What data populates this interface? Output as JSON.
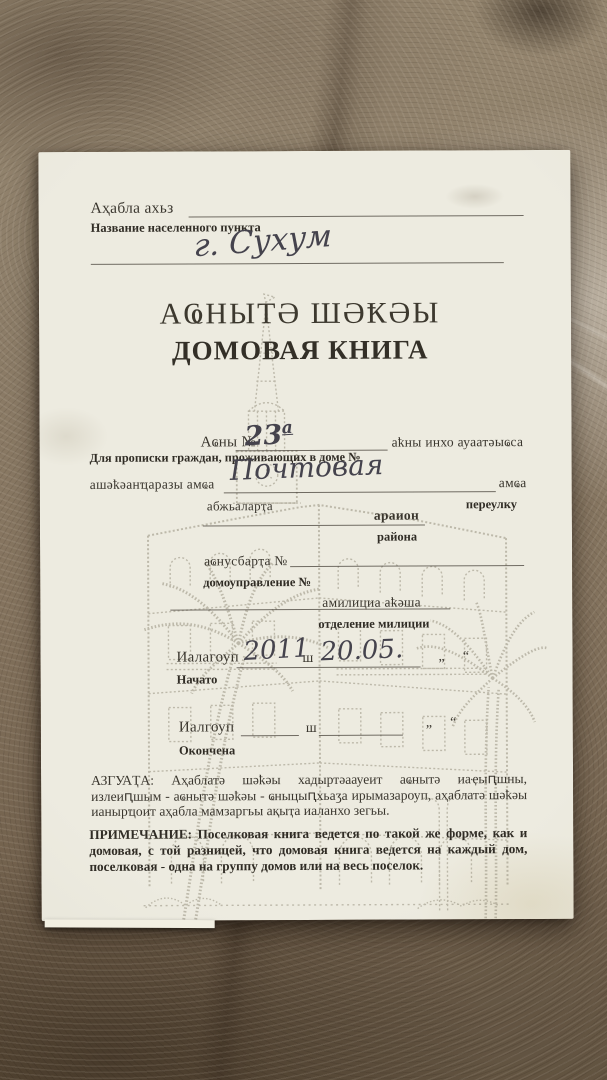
{
  "photo": {
    "surface": "marble countertop",
    "surface_base_color": "#87786a",
    "paper_color": "#eae8db"
  },
  "booklet": {
    "header": {
      "settlement_label_abkhaz": "Аҳабла ахьз",
      "settlement_label_russian": "Название населенного пункта",
      "settlement_value_handwritten": "г. Сухум"
    },
    "title": {
      "abkhaz": "АҨНЫТӘ ШӘҞӘЫ",
      "russian": "ДОМОВАЯ КНИГА"
    },
    "form": {
      "house_number": {
        "label_abkhaz": "Аҩны №",
        "value_handwritten": "23",
        "value_superscript": "а",
        "suffix_abkhaz": "аҟны инхо ауаатәыҩса",
        "label_russian": "Для прописки граждан, проживающих в доме №"
      },
      "street": {
        "label_abkhaz": "ашәҟәанҵаразы амҩа",
        "value_handwritten": "Почтовая",
        "suffix_abkhaz": "амҩа",
        "lane_label_abkhaz": "абжьаларҭа",
        "lane_label_russian": "переулку"
      },
      "district": {
        "label_abkhaz": "араион",
        "label_russian": "района"
      },
      "house_management": {
        "label_abkhaz": "аҩнусбарҭа №",
        "label_russian": "домоуправление №"
      },
      "militia": {
        "label_abkhaz": "амилициа аҟәша",
        "label_russian": "отделение милиции"
      },
      "started": {
        "label_abkhaz": "Иалагоуп",
        "label_russian": "Начато",
        "year_handwritten": "2011",
        "year_unit_abkhaz": "ш",
        "date_handwritten": "20.05.",
        "quote_marks": "„ “"
      },
      "finished": {
        "label_abkhaz": "Иалгоуп",
        "label_russian": "Окончена",
        "year_unit_abkhaz": "ш",
        "quote_marks": "„ “"
      }
    },
    "notes": {
      "abkhaz_label": "АЗГУАҬА:",
      "abkhaz_text": "Аҳаблатә шәҟәы хадыртәаауеит аҩнытә иаҿыԥшны, излеиԥшым - аҩнытә шәҟәы - ҩныцыԥхьаӡа ирымазароуп, аҳаблатә шәҟәы ианырҵоит аҳабла мамзаргьы ақыҭа иаланхо зегьы.",
      "russian_label": "ПРИМЕЧАНИЕ:",
      "russian_text": "Поселковая книга ведется по такой же форме, как и домовая, с той разницей, что домовая книга ведется на каждый дом, поселковая - одна на группу домов или на весь поселок."
    },
    "illustration": "faded halftone sketch of a corner building with clock tower spire and two palm trees"
  }
}
